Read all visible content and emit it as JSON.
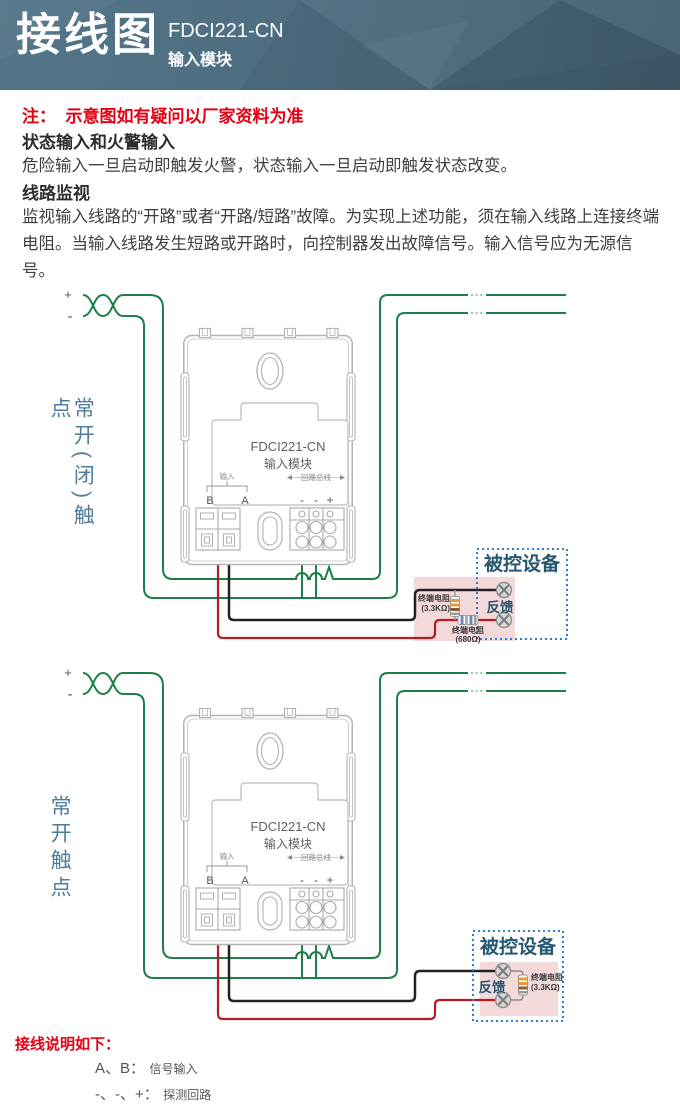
{
  "header": {
    "title": "接线图",
    "model": "FDCI221-CN",
    "subtitle": "输入模块"
  },
  "notes": {
    "note": "注：  示意图如有疑问以厂家资料为准",
    "section1_title": "状态输入和火警输入",
    "section1_body": "危险输入一旦启动即触发火警，状态输入一旦启动即触发状态改变。",
    "section2_title": "线路监视",
    "section2_body": "监视输入线路的“开路”或者“开路/短路”故障。为实现上述功能，须在输入线路上连接终端电阻。当输入线路发生短路或开路时，向控制器发出故障信号。输入信号应为无源信号。"
  },
  "module": {
    "name": "FDCI221-CN",
    "type": "输入模块",
    "input_label": "输入",
    "terminal_b": "B",
    "terminal_a": "A",
    "bus_label": "回路总线",
    "bus_t1": "-",
    "bus_t2": "-",
    "bus_t3": "+"
  },
  "wiring": {
    "plus": "+",
    "minus": "-"
  },
  "diagram1": {
    "contact_label": "常开(闭)触点",
    "device_title": "被控设备",
    "feedback_label": "反馈",
    "res1_name": "终端电阻",
    "res1_value": "(3.3KΩ)",
    "res2_name": "终端电阻",
    "res2_value": "(680Ω)"
  },
  "diagram2": {
    "contact_label": "常开触点",
    "device_title": "被控设备",
    "feedback_label": "反馈",
    "res1_name": "终端电阻",
    "res1_value": "(3.3KΩ)"
  },
  "footer": {
    "title": "接线说明如下：",
    "item1_key": "A、B：",
    "item1_value": "信号输入",
    "item2_key": "-、-、+：",
    "item2_value": "探测回路"
  },
  "colors": {
    "header_teal": "#4d6c80",
    "wire_green": "#1c7f47",
    "wire_red": "#b61b22",
    "wire_black": "#222222",
    "device_box_blue": "#2f7bd0",
    "device_title_navy": "#27586f",
    "contact_label_blue": "#4f7c9b",
    "pink_panel": "#f4d9db",
    "note_red": "#e60012"
  }
}
